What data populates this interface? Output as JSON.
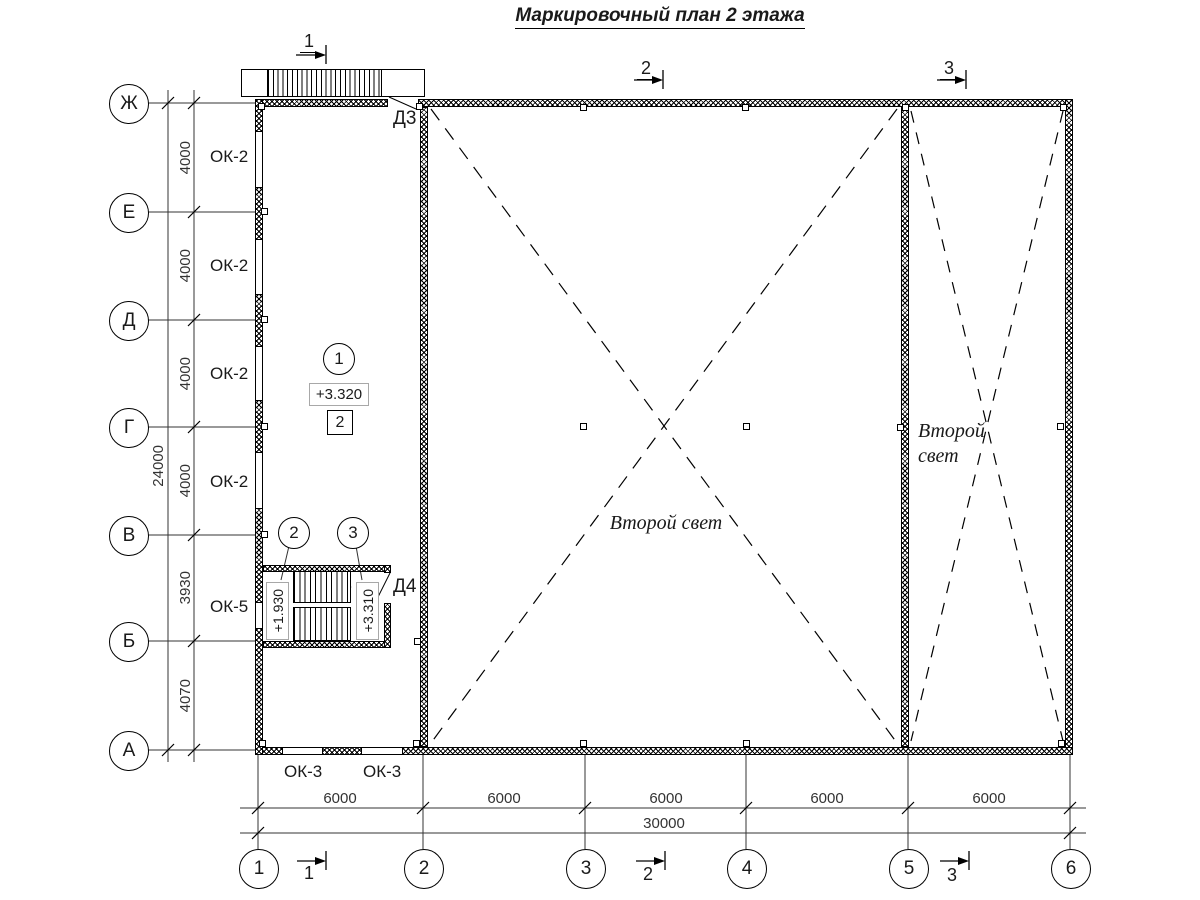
{
  "title": "Маркировочный план 2 этажа",
  "row_axes": [
    "Ж",
    "Е",
    "Д",
    "Г",
    "В",
    "Б",
    "А"
  ],
  "col_axes": [
    "1",
    "2",
    "3",
    "4",
    "5",
    "6"
  ],
  "v_dims": {
    "d1": "4000",
    "d2": "4000",
    "d3": "4000",
    "d4": "4000",
    "d5": "3930",
    "d6": "4070",
    "total": "24000"
  },
  "h_dims": {
    "d1": "6000",
    "d2": "6000",
    "d3": "6000",
    "d4": "6000",
    "d5": "6000",
    "total": "30000"
  },
  "windows": {
    "ok2_1": "ОК-2",
    "ok2_2": "ОК-2",
    "ok2_3": "ОК-2",
    "ok2_4": "ОК-2",
    "ok5": "ОК-5",
    "ok3_1": "ОК-3",
    "ok3_2": "ОК-3"
  },
  "doors": {
    "d3": "Д3",
    "d4": "Д4"
  },
  "levels": {
    "floor": "+3.320",
    "stair_mid": "+1.930",
    "stair_top": "+3.310"
  },
  "markers": {
    "node_circle": "1",
    "node_square": "2",
    "stair_mid": "2",
    "stair_top": "3"
  },
  "sections": {
    "top_1": "1",
    "top_2": "2",
    "top_3": "3",
    "bottom_1": "1",
    "bottom_2": "2",
    "bottom_3": "3"
  },
  "voids": {
    "hall": "Второй свет",
    "right_l1": "Второй",
    "right_l2": "свет"
  }
}
